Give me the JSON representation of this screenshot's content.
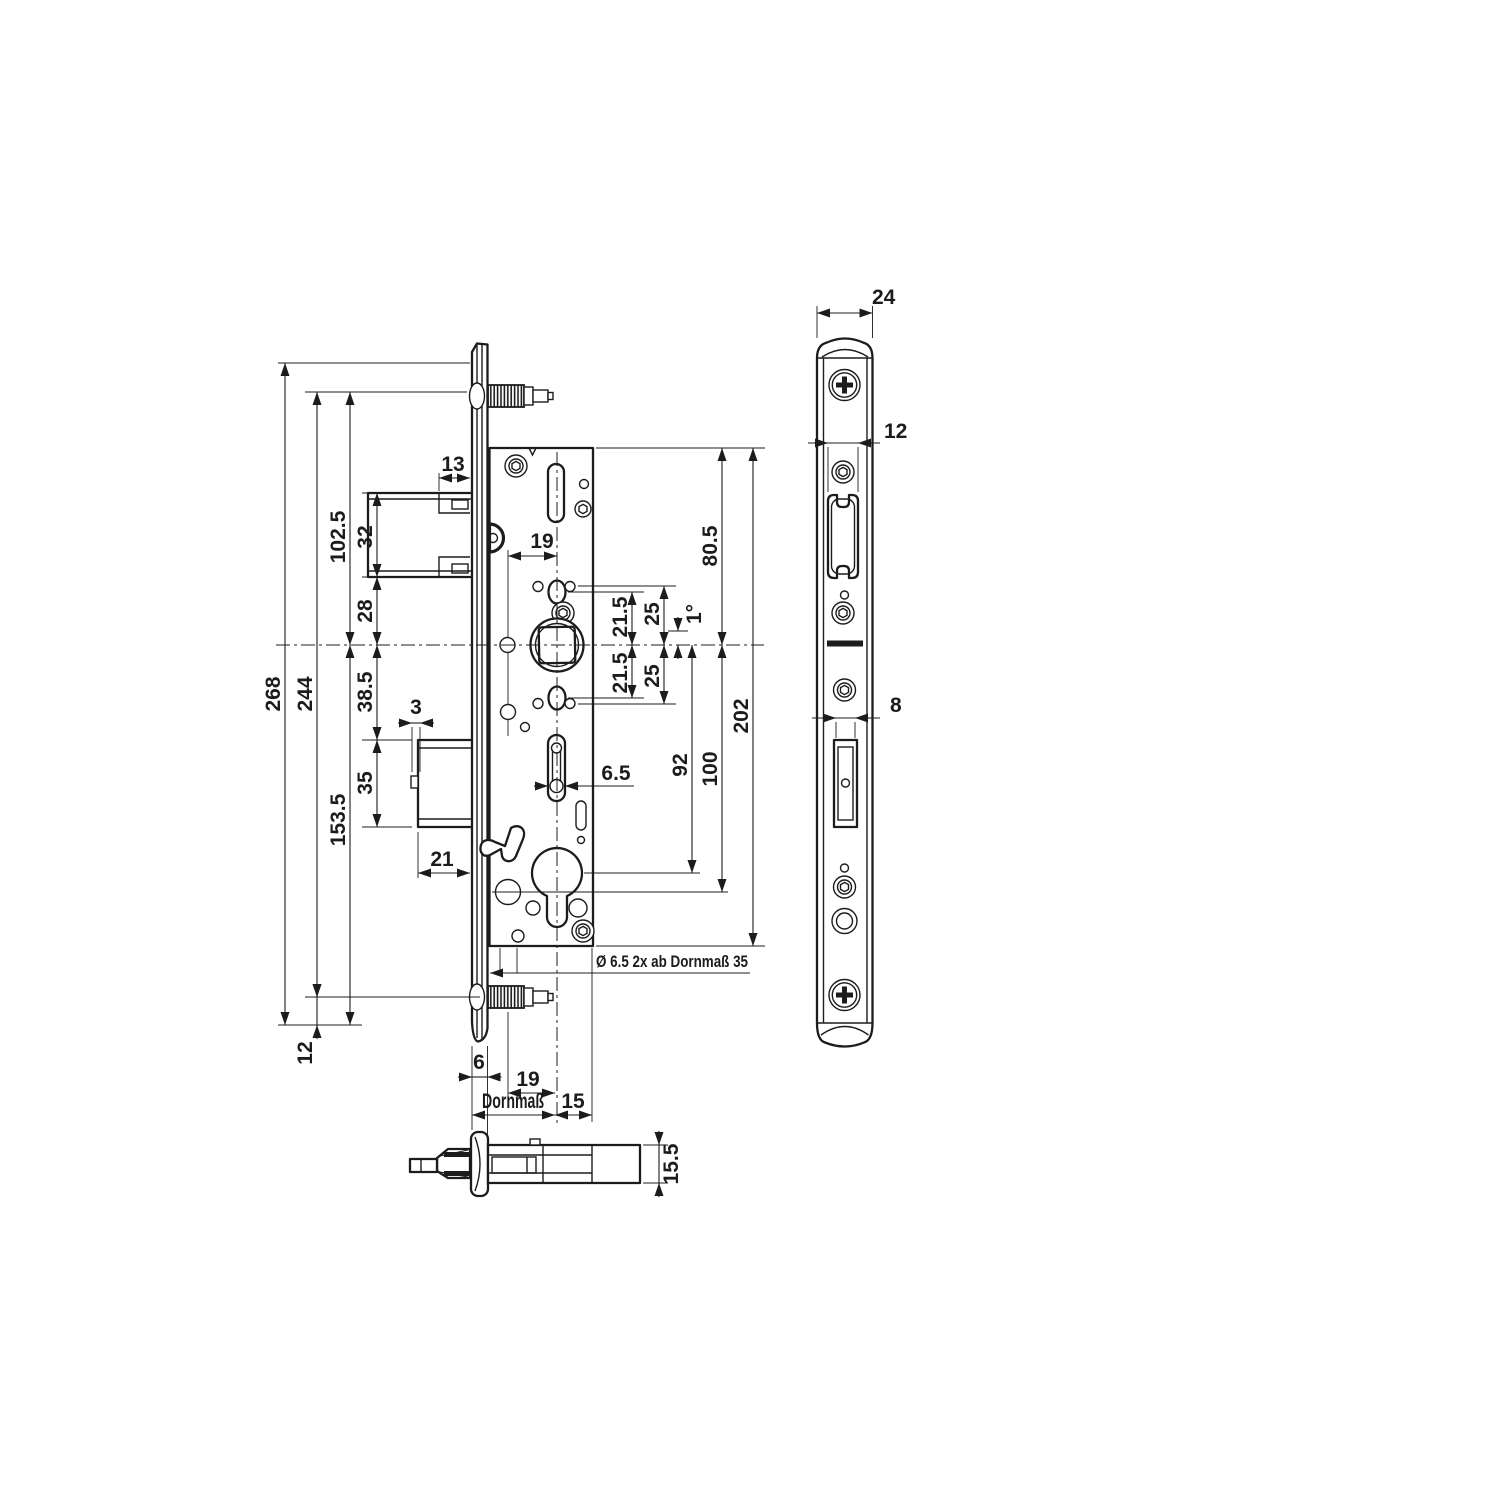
{
  "drawing": {
    "kind": "mortise-lock technical drawing",
    "views": [
      "side view lock case",
      "faceplate front view",
      "latch bottom view"
    ],
    "background_color": "#ffffff",
    "line_color": "#1c1c1c"
  },
  "labels": {
    "side": {
      "h268": "268",
      "h244": "244",
      "h102_5": "102.5",
      "h153_5": "153.5",
      "h12": "12",
      "h32": "32",
      "h28": "28",
      "h38_5": "38.5",
      "h35": "35",
      "w13": "13",
      "w3": "3",
      "w21": "21",
      "w19_top": "19",
      "v21_5_upper": "21.5",
      "v25_upper": "25",
      "v21_5_lower": "21.5",
      "v25_lower": "25",
      "angle": "1°",
      "v80_5": "80.5",
      "v100": "100",
      "v202": "202",
      "v92": "92",
      "w6_5": "6.5",
      "hole_note": "Ø 6.5 2x ab Dornmaß 35",
      "w6": "6",
      "w19_bottom": "19",
      "backset": "Dornmaß",
      "w15": "15"
    },
    "front": {
      "w24": "24",
      "w12": "12",
      "w8": "8"
    },
    "bottom": {
      "h15_5": "15.5"
    }
  }
}
